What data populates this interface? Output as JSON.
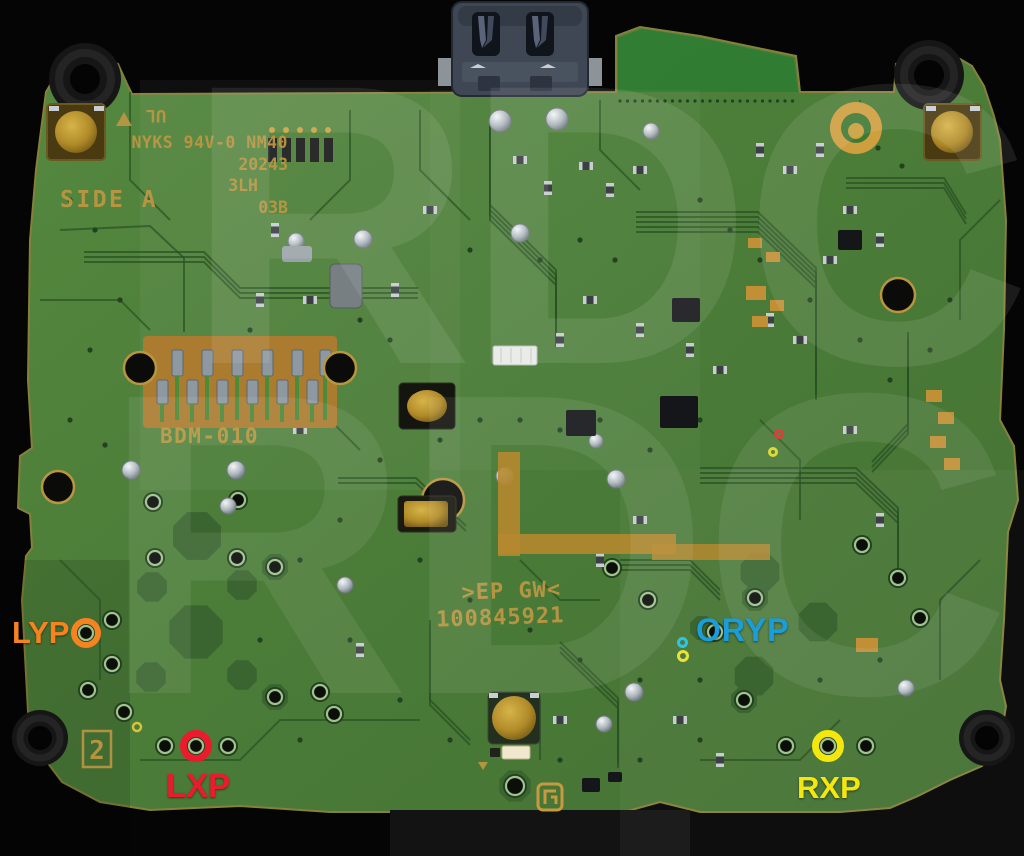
{
  "silkscreen": {
    "side_label": "SIDE A",
    "ul_mark": "UL",
    "mfr_line1": "NYKS 94V-0 NM40",
    "mfr_line2": "20243",
    "mfr_line3": "3LH",
    "mfr_line4": "03B",
    "connector_label": "BDM-010",
    "board_id_line1": ">EP GW<",
    "board_id_line2": "100845921",
    "position_marking": "2"
  },
  "watermark": {
    "text": "RDC"
  },
  "annotations": {
    "lyp": {
      "label": "LYP",
      "color": "#f5831f"
    },
    "lxp": {
      "label": "LXP",
      "color": "#ea1b2d"
    },
    "oryp": {
      "label": "ORYP",
      "color": "#1a9edb"
    },
    "rxp": {
      "label": "RXP",
      "color": "#f3e70e"
    }
  },
  "colors": {
    "background": "#050505",
    "board_green": "#4d7f3b",
    "trace_green": "#2a5124",
    "copper_gold": "#b5852f",
    "silkscreen_gold": "#bf9743",
    "solder_silver": "#c9d2d6"
  }
}
